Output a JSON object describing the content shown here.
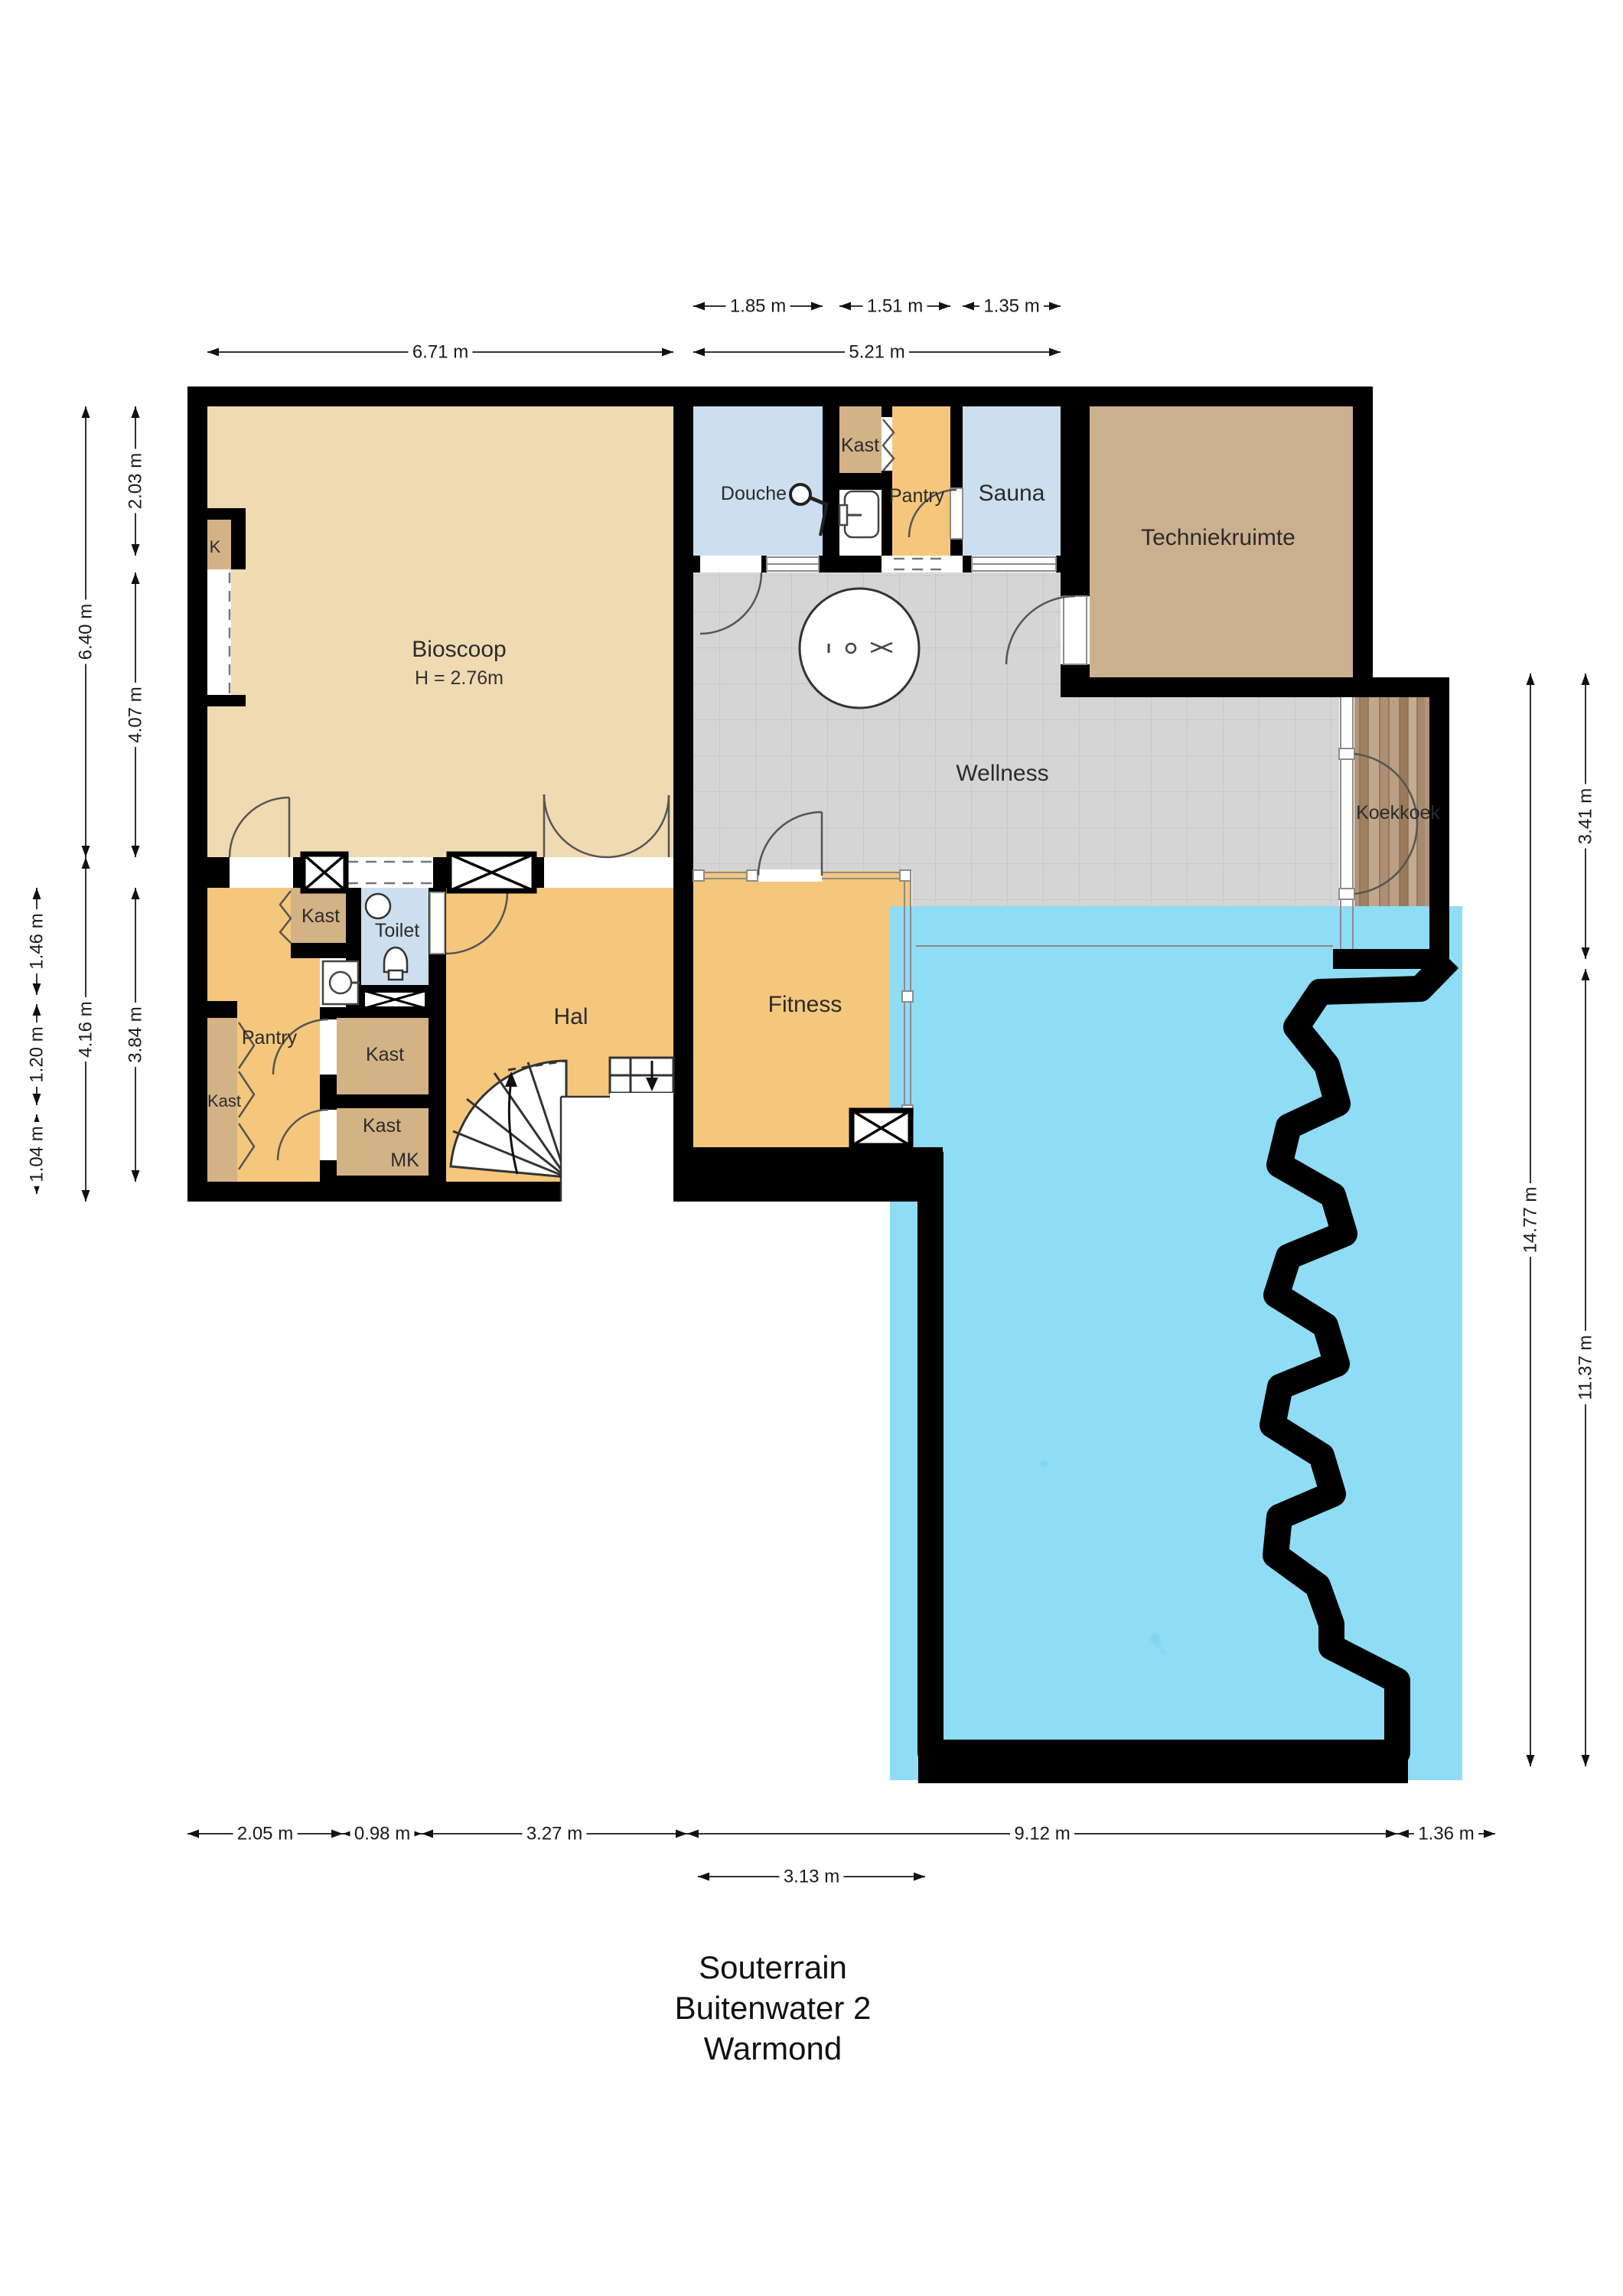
{
  "title": {
    "line1": "Souterrain",
    "line2": "Buitenwater 2",
    "line3": "Warmond"
  },
  "rooms": {
    "bioscoop": {
      "label": "Bioscoop",
      "ceiling": "H = 2.76m"
    },
    "k_closet": {
      "label": "K"
    },
    "douche": {
      "label": "Douche"
    },
    "kast_upper": {
      "label": "Kast"
    },
    "pantry_upper": {
      "label": "Pantry"
    },
    "sauna": {
      "label": "Sauna"
    },
    "techniekruimte": {
      "label": "Techniekruimte"
    },
    "wellness": {
      "label": "Wellness"
    },
    "koekkoek": {
      "label": "Koekkoek"
    },
    "pantry_lower": {
      "label": "Pantry"
    },
    "kast_left": {
      "label": "Kast"
    },
    "kast_top": {
      "label": "Kast"
    },
    "toilet": {
      "label": "Toilet"
    },
    "kast_mid": {
      "label": "Kast"
    },
    "kast_lower": {
      "label": "Kast"
    },
    "mk": {
      "label": "MK"
    },
    "hal": {
      "label": "Hal"
    },
    "fitness": {
      "label": "Fitness"
    }
  },
  "dims": {
    "top_row1": [
      {
        "label": "1.85 m"
      },
      {
        "label": "1.51 m"
      },
      {
        "label": "1.35 m"
      }
    ],
    "top_row2": [
      {
        "label": "6.71 m"
      },
      {
        "label": "5.21 m"
      }
    ],
    "left_far": [
      {
        "label": "1.46 m"
      },
      {
        "label": "1.20 m"
      },
      {
        "label": "1.04 m"
      }
    ],
    "left_outer": [
      {
        "label": "6.40 m"
      },
      {
        "label": "4.16 m"
      }
    ],
    "left_inner": [
      {
        "label": "2.03 m"
      },
      {
        "label": "4.07 m"
      },
      {
        "label": "3.84 m"
      }
    ],
    "right_outer": [
      {
        "label": "14.77 m"
      }
    ],
    "right_inner": [
      {
        "label": "3.41 m"
      },
      {
        "label": "11.37 m"
      }
    ],
    "bottom_row1": [
      {
        "label": "2.05 m"
      },
      {
        "label": "0.98 m"
      },
      {
        "label": "3.27 m"
      },
      {
        "label": "9.12 m"
      },
      {
        "label": "1.36 m"
      }
    ],
    "bottom_row2": [
      {
        "label": "3.13 m"
      }
    ]
  },
  "colors": {
    "wall": "#000000",
    "room_beige": "#efdab1",
    "room_orange": "#f5c77c",
    "room_tan": "#d3b286",
    "tech_tan": "#cbb090",
    "room_blue": "#cddfee",
    "room_gray": "#d5d5d5",
    "water": "#1d9ad2",
    "water_light": "#8fdcf5",
    "wood": "#b2947a"
  }
}
